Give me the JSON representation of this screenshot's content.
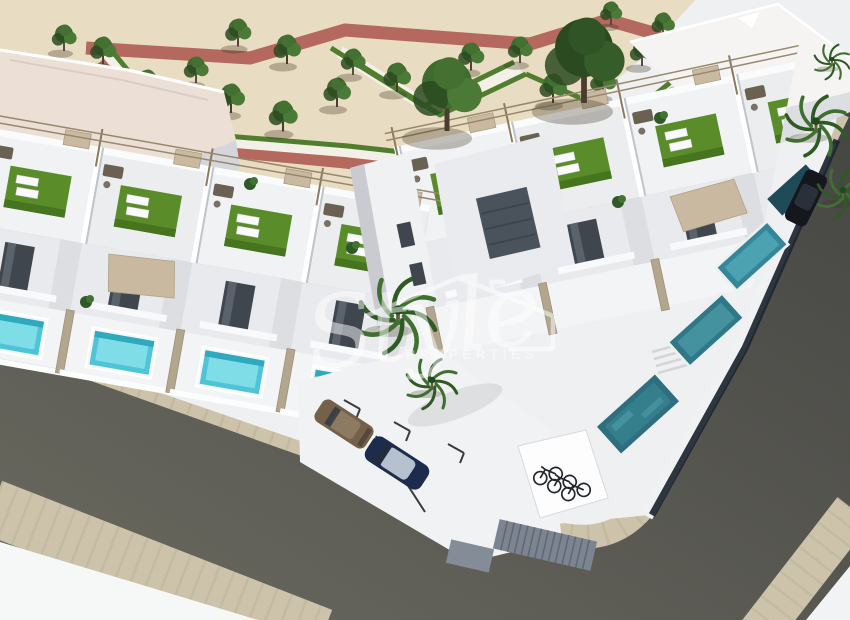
{
  "watermark": {
    "brand_script": "Style",
    "brand_caption": "PROPERTIES",
    "icon": "house-outline-icon"
  },
  "palette": {
    "bg-light": "#eef0f1",
    "sand": "#e8dcc2",
    "path-red": "#b5685e",
    "path-white": "#f3f0e7",
    "hedge-green": "#507d2e",
    "tree-green": "#3e6a2e",
    "tree-dark": "#2b4a20",
    "grass-green": "#5a8c2a",
    "grass-dark": "#47741f",
    "white-wall": "#f2f2f4",
    "wall-shade": "#d5d6db",
    "roof-pink": "#ecdfd6",
    "pool-light": "#7fdde8",
    "pool-mid": "#4fc4d6",
    "pool-teal": "#2e6e7e",
    "road-dark": "#4a4a47",
    "road-light": "#6b6a60",
    "sidewalk-tan": "#cdc3ab",
    "fence-tan": "#b2a78e",
    "canopy-tan": "#c9b9a0",
    "window-dark": "#3f464e",
    "car-navy": "#1d2c4d",
    "car-bronze": "#756049",
    "watermark-white": "#ffffff"
  }
}
